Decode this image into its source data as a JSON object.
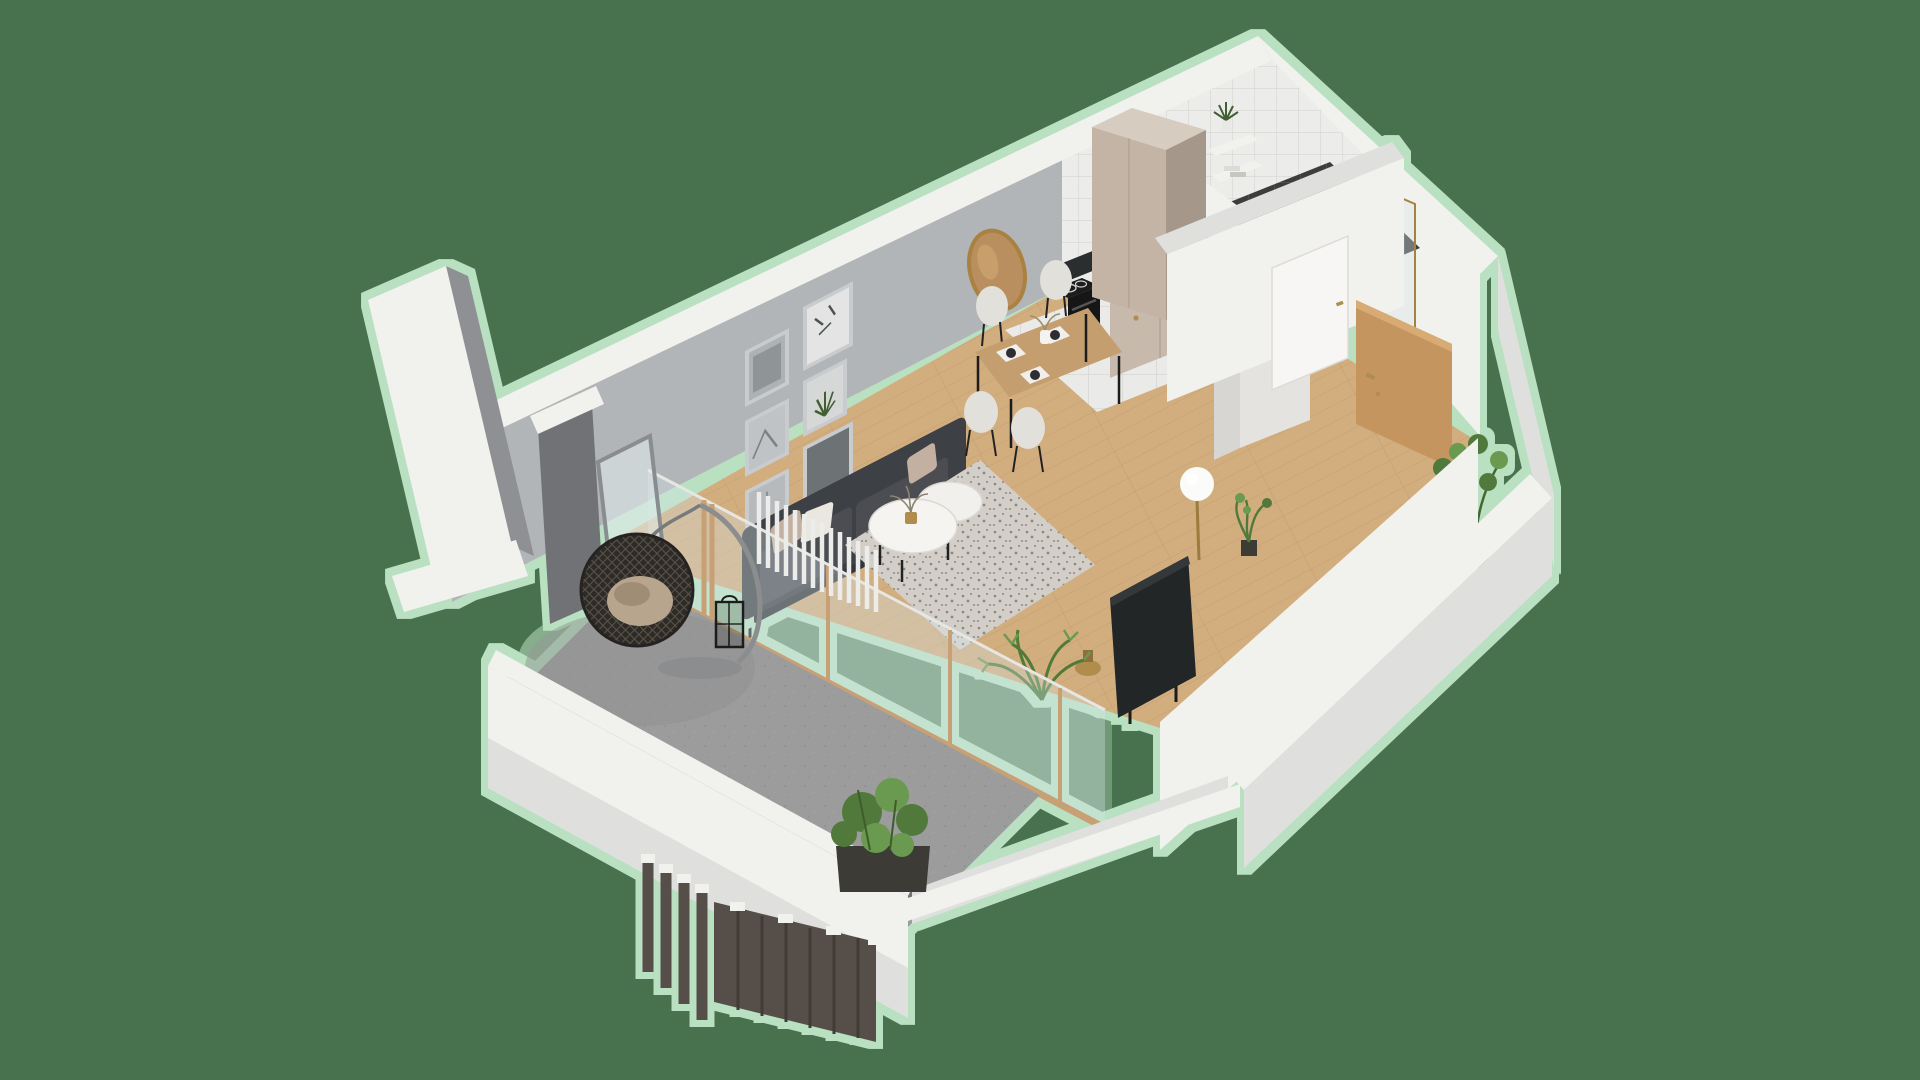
{
  "scene": {
    "type": "isometric-3d-apartment-cutaway-render",
    "background": "solid muted green with light-green pixelated halo around the model",
    "rooms": [
      {
        "name": "living-room",
        "floor": "oak-planks",
        "objects": [
          "dark-gray-sofa-with-beige-and-white-cushions",
          "two-tier-round-marble-coffee-table",
          "gold-vase-with-twigs",
          "speckled-gray-area-rug",
          "gallery-wall-six-framed-prints",
          "round-gold-framed-wall-mirror",
          "white-vertical-slat-divider",
          "flat-screen-tv-on-floor-stand",
          "palm-plant",
          "small-gold-side-table"
        ]
      },
      {
        "name": "dining-area",
        "floor": "oak-planks",
        "objects": [
          "wood-dining-table-black-metal-legs",
          "four-white-shell-chairs",
          "white-placemats-with-dark-plates",
          "white-vase-with-dried-flowers"
        ]
      },
      {
        "name": "kitchen",
        "floor": "white-tiles",
        "objects": [
          "black-stove-column-with-induction-hob",
          "dark-marble-countertop-and-backsplash",
          "beige-cabinet-fronts-with-brass-knobs",
          "black-undermount-sink",
          "black-faucet",
          "coffee-machine",
          "green-cutting-boards",
          "tall-beige-wardrobe",
          "tall-gray-cabinet"
        ]
      },
      {
        "name": "laundry-nook",
        "objects": [
          "washing-machine-behind-half-wall"
        ]
      },
      {
        "name": "bathroom",
        "floor": "dark-tiles",
        "walls": "white-square-tiles",
        "objects": [
          "walk-in-shower-brass-framed-glass",
          "gold-shower-set",
          "black-towel-radiator",
          "white-vanity-counter",
          "wall-shelves-with-plant-and-towels"
        ]
      },
      {
        "name": "hallway",
        "floor": "oak-planks",
        "objects": [
          "open-oak-entrance-door-with-gold-handle",
          "closed-white-bathroom-door-with-gold-handle",
          "white-globe-floor-lamp-brass-stem",
          "small-potted-plant",
          "tall-potted-plant"
        ]
      },
      {
        "name": "balcony",
        "floor": "concrete",
        "objects": [
          "hanging-rattan-egg-chair-with-cushion",
          "black-candle-lantern",
          "leaning-framed-mirror",
          "green-shrub-in-dark-planter",
          "dark-wood-slat-privacy-fence-with-white-caps",
          "white-parapet-walls",
          "separate-white-exterior-wall-slab"
        ]
      }
    ]
  },
  "colors": {
    "background_green": "#48714e",
    "halo_green": "#b9e0c1",
    "wall_white": "#f1f1ee",
    "wall_white_shade": "#dfe0dd",
    "wall_white_dark": "#cdd0ce",
    "wall_gray": "#b2b5b8",
    "wall_gray_mid": "#8e9093",
    "wall_gray_dark": "#6f7274",
    "tile_wall": "#ececea",
    "tile_grout": "#d9d9d5",
    "floor_wood": "#d2ad7e",
    "floor_wood_line": "#b8946a",
    "floor_tile": "#eaeae8",
    "floor_concrete": "#9c9c9d",
    "floor_bath_dark": "#3d3d3d",
    "counter_dark": "#2c2d2f",
    "cabinet_beige": "#c7b9ab",
    "wardrobe_light": "#c3b4a5",
    "wardrobe_dark": "#a5978a",
    "wardrobe_top": "#d6ccc0",
    "sofa_dark": "#3e4145",
    "sofa_seat": "#4b4e53",
    "sofa_base": "#33363a",
    "pillow_beige": "#c3b0a0",
    "pillow_white": "#eae7e1",
    "rug_light": "#d3cfc8",
    "rug_speck": "#8a8782",
    "table_wood": "#c59e70",
    "chair_white": "#e2e0da",
    "accent_gold": "#b08c4e",
    "tv_dark": "#242628",
    "plant_green": "#51793b",
    "plant_green_light": "#6b9a50",
    "door_wood": "#c4955f",
    "black": "#1a1a1a",
    "glass_tint": "rgba(215,228,232,0.35)",
    "concrete_dark": "#87888a",
    "slat_wood_dark": "#57504a"
  }
}
